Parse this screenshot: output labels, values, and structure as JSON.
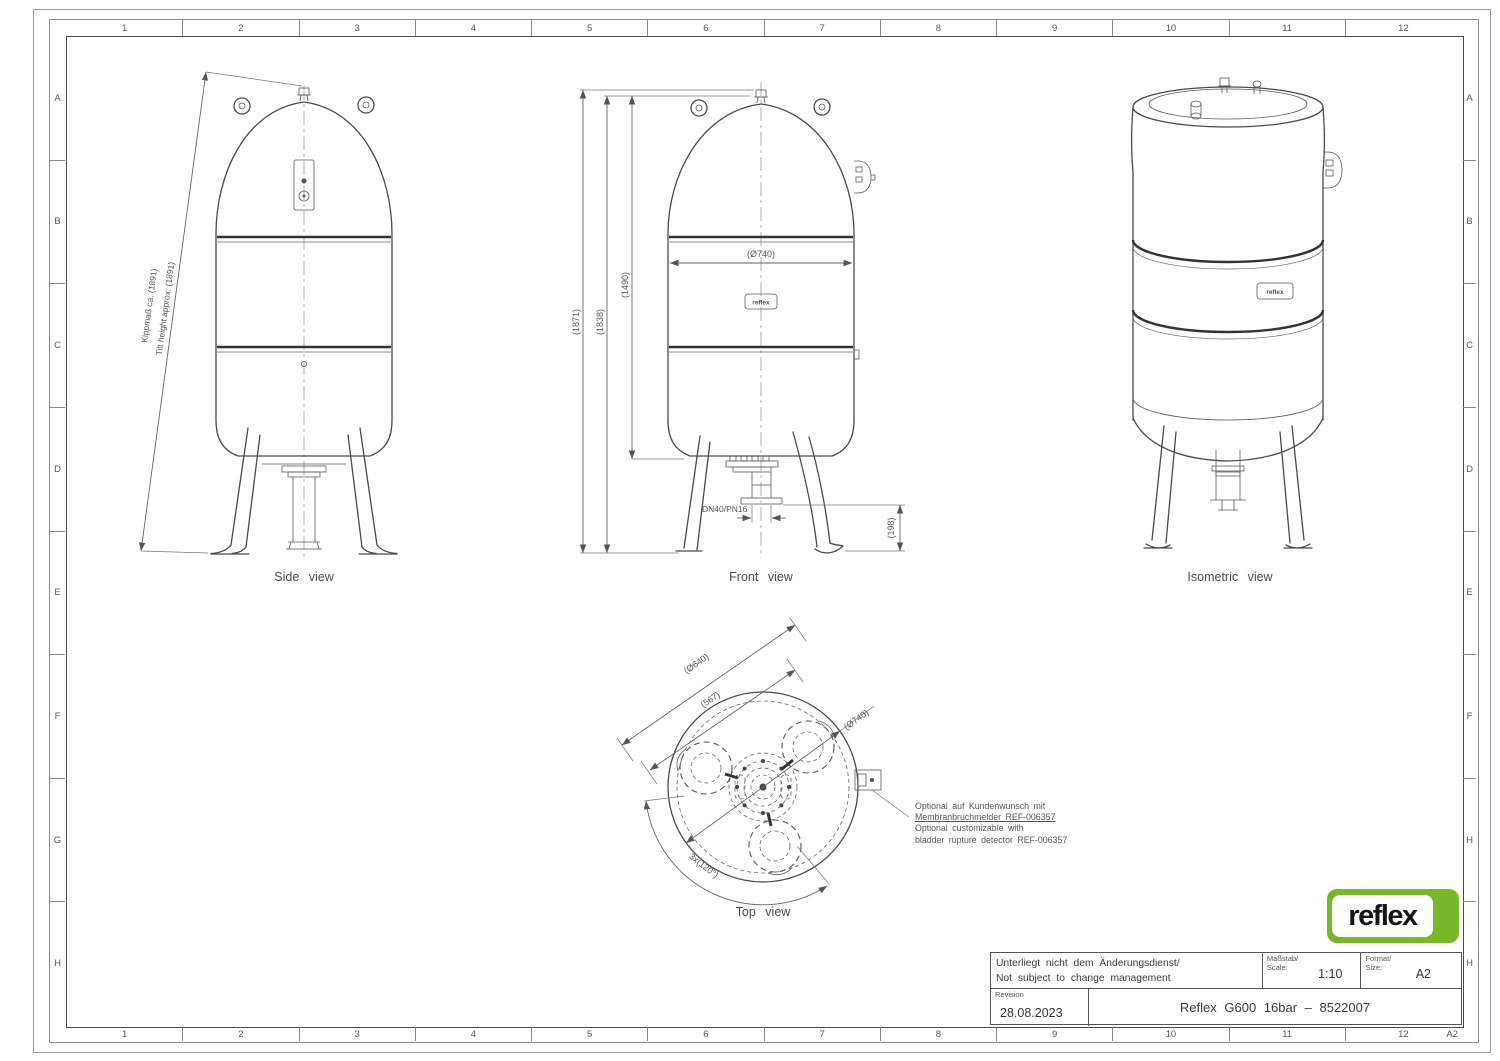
{
  "frame": {
    "columns": [
      "1",
      "2",
      "3",
      "4",
      "5",
      "6",
      "7",
      "8",
      "9",
      "10",
      "11",
      "12"
    ],
    "rows": [
      "A",
      "B",
      "C",
      "D",
      "E",
      "F",
      "G",
      "H"
    ],
    "corner_label": "A2"
  },
  "views": {
    "side": {
      "label": "Side view",
      "tilt_dim_de": "Kippmaß ca. (1891)",
      "tilt_dim_en": "Tilt height approx. (1891)"
    },
    "front": {
      "label": "Front view",
      "dim_total_height": "(1871)",
      "dim_vessel_height": "(1838)",
      "dim_upper_height": "(1490)",
      "dim_diameter": "(Ø740)",
      "dim_connection": "DN40/PN16",
      "dim_clearance": "(198)"
    },
    "isometric": {
      "label": "Isometric view"
    },
    "top": {
      "label": "Top view",
      "dim_feet_circle": "(Ø640)",
      "dim_feet_spacing": "(567)",
      "dim_diameter": "(Ø740)",
      "dim_feet_angle": "3x(120°)"
    }
  },
  "annotation": {
    "line1_de": "Optional auf Kundenwunsch mit",
    "line2_de": "Membranbruchmelder REF-006357",
    "line3_en": "Optional customizable with",
    "line4_en": "bladder rupture detector REF-006357"
  },
  "brand": {
    "logo_text": "reflex",
    "logo_green": "#76b82a",
    "vessel_plate_text": "reflex"
  },
  "title_block": {
    "note_de": "Unterliegt nicht dem Änderungsdienst/",
    "note_en": "Not subject to change management",
    "scale_label_de": "Maßstab/",
    "scale_label_en": "Scale:",
    "scale_value": "1:10",
    "format_label_de": "Format/",
    "format_label_en": "Size:",
    "format_value": "A2",
    "revision_label": "Revision",
    "revision_date": "28.08.2023",
    "drawing_title": "Reflex G600 16bar – 8522007"
  }
}
